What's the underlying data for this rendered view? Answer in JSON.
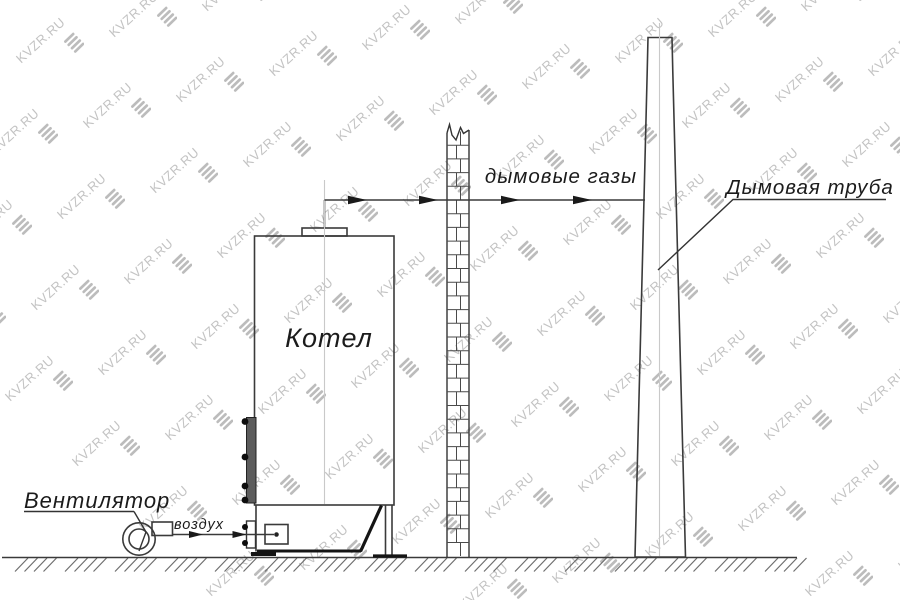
{
  "labels": {
    "boiler": "Котел",
    "fan": "Вентилятор",
    "air": "воздух",
    "flue_gases": "дымовые газы",
    "chimney": "Дымовая труба"
  },
  "watermark": {
    "text": "KVZR.RU"
  },
  "colors": {
    "line": "#3a3a3a",
    "thick_line": "#141414",
    "centerline": "#c9c9c9",
    "label": "#1b1b1b",
    "door_fill": "#5c5c5c",
    "watermark_text": "#c3c3c3",
    "watermark_logo": "#bcbcbc"
  }
}
